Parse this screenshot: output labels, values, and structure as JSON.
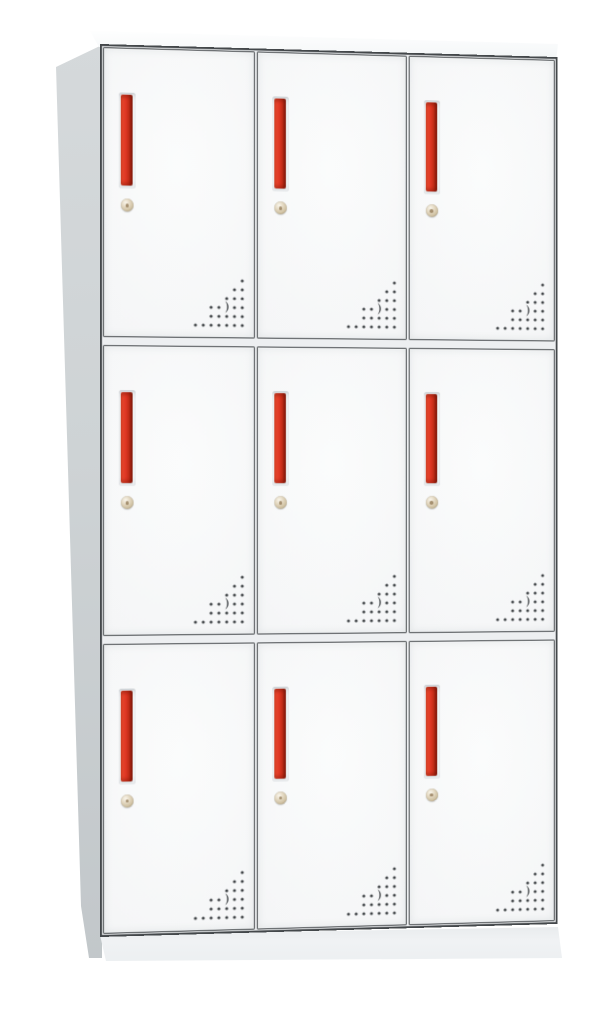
{
  "scene": {
    "type": "product-photo",
    "subject": "nine-door metal locker cabinet with red handles",
    "background_color": "#ffffff"
  },
  "cabinet": {
    "rows": 3,
    "columns": 3,
    "door_count": 9,
    "colors": {
      "frame": "#44484b",
      "door_face": "#f5f6f7",
      "door_face_light": "#fbfcfc",
      "gap_fill": "#edeff1",
      "side_panel_top": "#d5d9db",
      "side_panel_bottom": "#c2c7ca",
      "top_surface": "#f7f9fa",
      "base": "#f0f2f4",
      "handle_red": "#dc3522",
      "handle_red_dark": "#9a2010",
      "handle_red_light": "#ee4e31",
      "lock_beige": "#e0d4bc",
      "lock_center": "#8d7450",
      "vent_dot": "#43474a"
    },
    "door": {
      "handle": {
        "shape": "vertical-bar",
        "width_px": 12,
        "height_px": 91
      },
      "lock": {
        "shape": "round-cam-lock",
        "diameter_px": 13
      },
      "vent": {
        "pattern": "triangular-perforation-with-crescent",
        "dot_radius": 1.6,
        "rows_y": [
          5,
          14,
          23,
          32,
          41,
          50
        ],
        "rows_dots": [
          [
            52
          ],
          [
            44,
            52
          ],
          [
            36,
            44,
            52
          ],
          [
            20,
            28,
            44,
            52
          ],
          [
            20,
            28,
            36,
            44,
            52
          ],
          [
            4,
            12,
            20,
            28,
            36,
            44,
            52
          ]
        ],
        "crescent_path": "M34.5 25.5 C39 28.5 39 34.5 34.5 37.5 C37 34 37 29 34.5 25.5 Z"
      }
    }
  }
}
